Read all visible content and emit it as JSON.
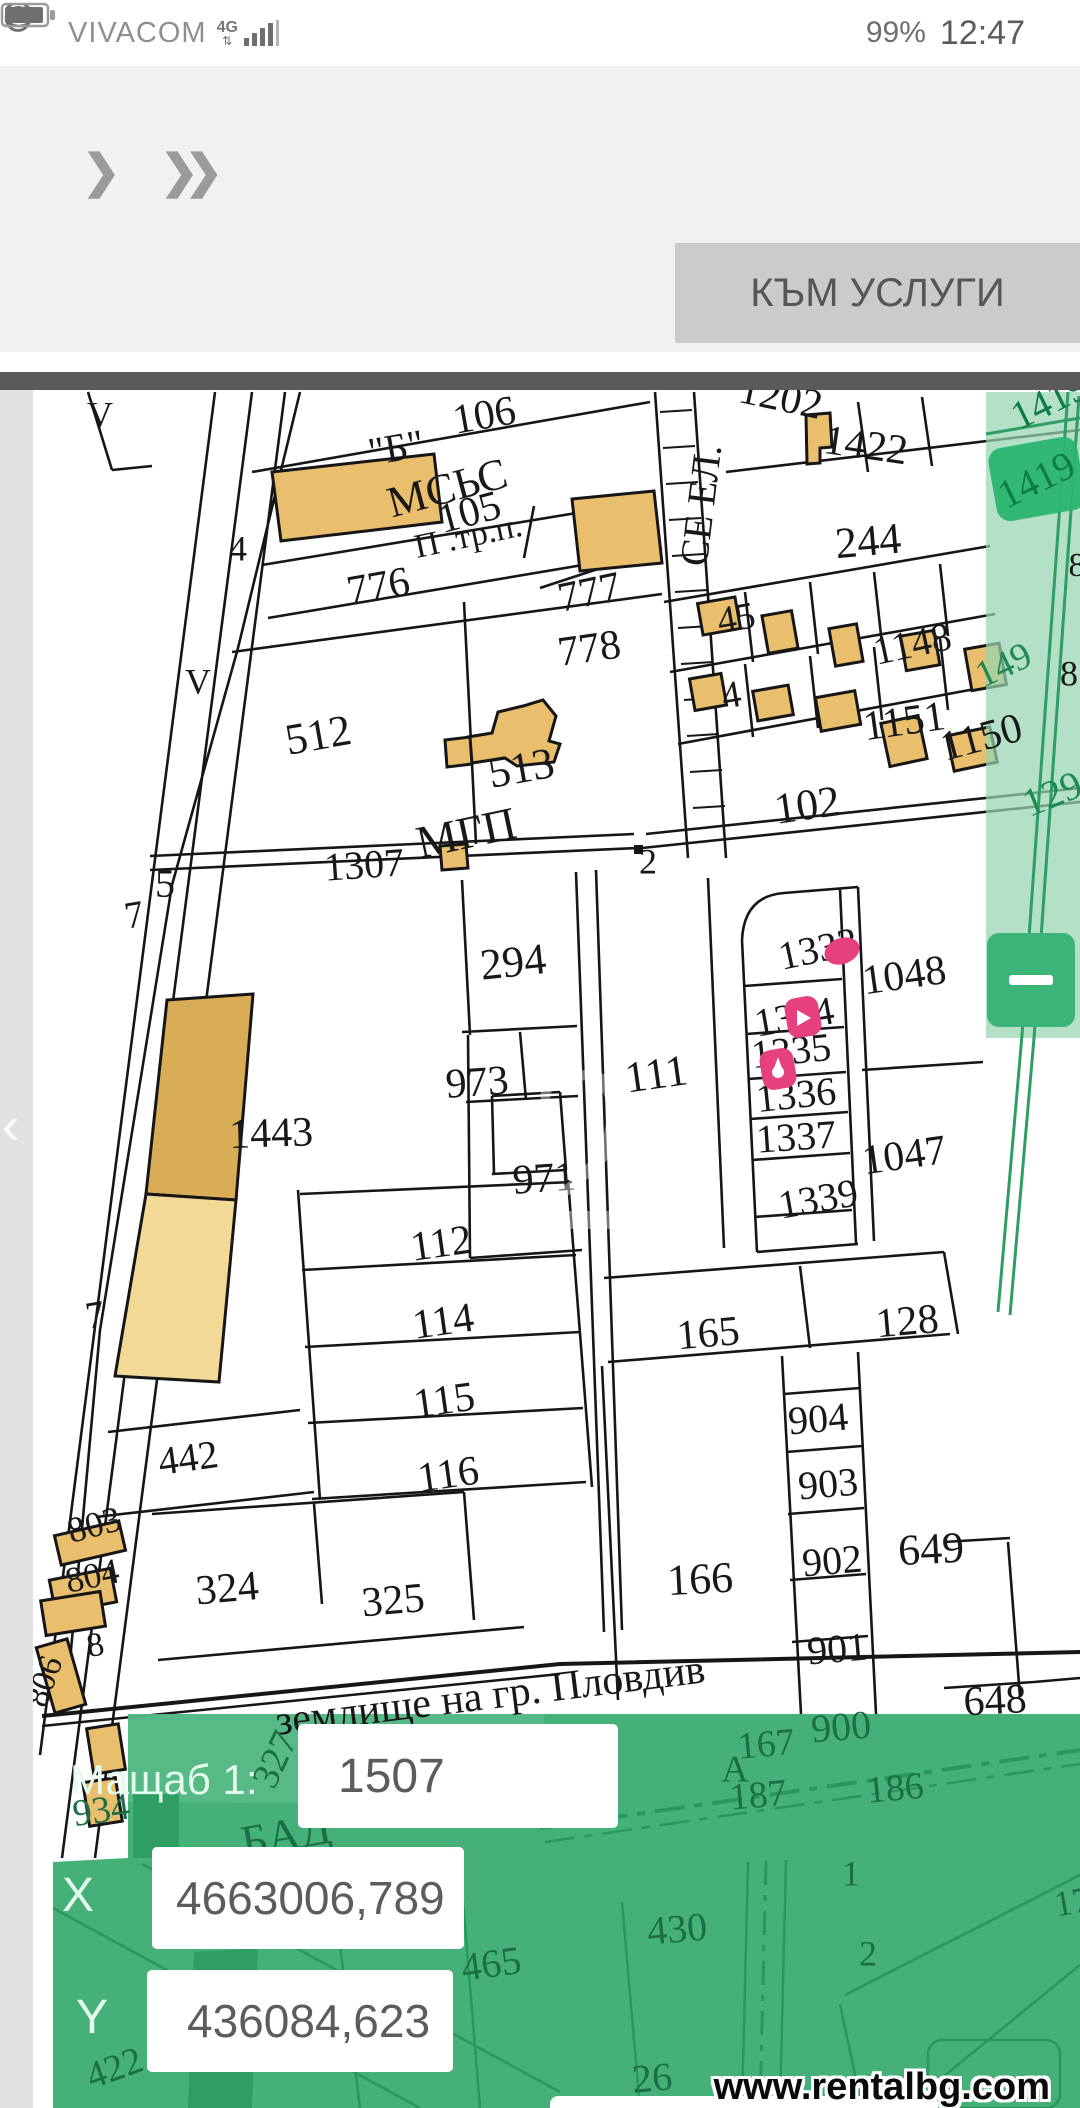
{
  "status_bar": {
    "carrier": "VIVACOM",
    "network": "4G",
    "battery_percent": "99%",
    "time": "12:47",
    "icons": [
      "data-arrows-icon",
      "signal-bars-icon",
      "eye-icon",
      "alarm-clock-icon",
      "battery-icon"
    ]
  },
  "toolbar": {
    "forward_label": "❯",
    "forward_double_label": "❯❯",
    "services_button": "КЪМ УСЛУГИ"
  },
  "map": {
    "back_chevron": "‹",
    "zoom_out_glyph": "–",
    "marker_color": "#e6407e",
    "label_colors": {
      "black": "#181818",
      "green": "#1e8a50",
      "green_dark": "#0e7c46",
      "panel": "#1c6f45",
      "faint": "rgba(255,255,255,0.40)"
    },
    "markers": [
      {
        "x": 842,
        "y": 951,
        "type": "blob"
      },
      {
        "x": 803,
        "y": 1017,
        "type": "pin"
      },
      {
        "x": 778,
        "y": 1069,
        "type": "pin2"
      }
    ],
    "labels": [
      {
        "t": "\"Б\"",
        "x": 396,
        "y": 447,
        "r": -10,
        "s": 40
      },
      {
        "t": "106",
        "x": 484,
        "y": 414,
        "r": -10,
        "s": 42
      },
      {
        "t": "МСЬС",
        "x": 447,
        "y": 487,
        "r": -15,
        "s": 44
      },
      {
        "t": "105",
        "x": 469,
        "y": 511,
        "r": -15,
        "s": 42
      },
      {
        "t": "П .тр.п.",
        "x": 468,
        "y": 535,
        "r": -12,
        "s": 34
      },
      {
        "t": "776",
        "x": 378,
        "y": 585,
        "r": -10,
        "s": 42
      },
      {
        "t": "777",
        "x": 589,
        "y": 591,
        "r": -12,
        "s": 42
      },
      {
        "t": "778",
        "x": 589,
        "y": 647,
        "r": -8,
        "s": 42
      },
      {
        "t": "1202",
        "x": 781,
        "y": 396,
        "r": 12,
        "s": 42
      },
      {
        "t": "1422",
        "x": 866,
        "y": 444,
        "r": 8,
        "s": 42
      },
      {
        "t": "244",
        "x": 868,
        "y": 540,
        "r": -5,
        "s": 44
      },
      {
        "t": "СЕ ЕЛ.",
        "x": 700,
        "y": 505,
        "r": -83,
        "s": 40
      },
      {
        "t": "45",
        "x": 736,
        "y": 617,
        "r": -10,
        "s": 38
      },
      {
        "t": "1148",
        "x": 912,
        "y": 643,
        "r": -12,
        "s": 40
      },
      {
        "t": "149",
        "x": 1003,
        "y": 664,
        "r": -25,
        "s": 38,
        "c": "green"
      },
      {
        "t": "4",
        "x": 731,
        "y": 694,
        "r": -10,
        "s": 38
      },
      {
        "t": "1151",
        "x": 904,
        "y": 720,
        "r": -8,
        "s": 42
      },
      {
        "t": "1150",
        "x": 981,
        "y": 736,
        "r": -15,
        "s": 42
      },
      {
        "t": "102",
        "x": 807,
        "y": 804,
        "r": -8,
        "s": 44
      },
      {
        "t": "129",
        "x": 1052,
        "y": 793,
        "r": -22,
        "s": 40,
        "c": "green"
      },
      {
        "t": "8",
        "x": 1069,
        "y": 673,
        "r": 0,
        "s": 36
      },
      {
        "t": "8",
        "x": 1077,
        "y": 564,
        "r": 0,
        "s": 34
      },
      {
        "t": "1419",
        "x": 1036,
        "y": 479,
        "r": -26,
        "s": 40,
        "c": "green_dark"
      },
      {
        "t": "1419",
        "x": 1049,
        "y": 400,
        "r": -26,
        "s": 40,
        "c": "green_dark"
      },
      {
        "t": "V",
        "x": 100,
        "y": 414,
        "r": 0,
        "s": 36
      },
      {
        "t": "4",
        "x": 238,
        "y": 548,
        "r": 0,
        "s": 36
      },
      {
        "t": "V",
        "x": 198,
        "y": 681,
        "r": 0,
        "s": 36
      },
      {
        "t": "5",
        "x": 165,
        "y": 883,
        "r": 0,
        "s": 40
      },
      {
        "t": "7",
        "x": 134,
        "y": 914,
        "r": -10,
        "s": 38
      },
      {
        "t": "7",
        "x": 95,
        "y": 1314,
        "r": -10,
        "s": 38
      },
      {
        "t": "512",
        "x": 318,
        "y": 734,
        "r": -10,
        "s": 44
      },
      {
        "t": "513",
        "x": 521,
        "y": 767,
        "r": -10,
        "s": 44
      },
      {
        "t": "МГП",
        "x": 466,
        "y": 832,
        "r": -12,
        "s": 46
      },
      {
        "t": "1307",
        "x": 364,
        "y": 864,
        "r": -4,
        "s": 40
      },
      {
        "t": "2",
        "x": 648,
        "y": 861,
        "r": 0,
        "s": 36
      },
      {
        "t": "294",
        "x": 513,
        "y": 961,
        "r": -6,
        "s": 44
      },
      {
        "t": "973",
        "x": 477,
        "y": 1081,
        "r": -4,
        "s": 42
      },
      {
        "t": "971",
        "x": 544,
        "y": 1177,
        "r": -4,
        "s": 42
      },
      {
        "t": "111",
        "x": 656,
        "y": 1073,
        "r": -8,
        "s": 44
      },
      {
        "t": "1443",
        "x": 271,
        "y": 1132,
        "r": -2,
        "s": 42
      },
      {
        "t": "1333",
        "x": 818,
        "y": 948,
        "r": -12,
        "s": 40
      },
      {
        "t": "1334",
        "x": 794,
        "y": 1016,
        "r": -10,
        "s": 40
      },
      {
        "t": "1335",
        "x": 791,
        "y": 1050,
        "r": -6,
        "s": 40
      },
      {
        "t": "1336",
        "x": 796,
        "y": 1094,
        "r": -6,
        "s": 40
      },
      {
        "t": "1337",
        "x": 796,
        "y": 1136,
        "r": -4,
        "s": 40
      },
      {
        "t": "1339",
        "x": 818,
        "y": 1198,
        "r": -10,
        "s": 40
      },
      {
        "t": "1048",
        "x": 904,
        "y": 974,
        "r": -8,
        "s": 42
      },
      {
        "t": "1047",
        "x": 904,
        "y": 1154,
        "r": -8,
        "s": 42
      },
      {
        "t": "112",
        "x": 441,
        "y": 1242,
        "r": -8,
        "s": 42
      },
      {
        "t": "114",
        "x": 443,
        "y": 1320,
        "r": -8,
        "s": 42
      },
      {
        "t": "115",
        "x": 444,
        "y": 1399,
        "r": -8,
        "s": 42
      },
      {
        "t": "116",
        "x": 448,
        "y": 1473,
        "r": -8,
        "s": 42
      },
      {
        "t": "442",
        "x": 188,
        "y": 1457,
        "r": -8,
        "s": 40
      },
      {
        "t": "165",
        "x": 708,
        "y": 1332,
        "r": -5,
        "s": 42
      },
      {
        "t": "128",
        "x": 907,
        "y": 1320,
        "r": -5,
        "s": 42
      },
      {
        "t": "904",
        "x": 818,
        "y": 1418,
        "r": -5,
        "s": 40
      },
      {
        "t": "903",
        "x": 828,
        "y": 1483,
        "r": -5,
        "s": 40
      },
      {
        "t": "902",
        "x": 832,
        "y": 1560,
        "r": -5,
        "s": 40
      },
      {
        "t": "901",
        "x": 837,
        "y": 1648,
        "r": -5,
        "s": 40
      },
      {
        "t": "900",
        "x": 841,
        "y": 1726,
        "r": -5,
        "s": 40,
        "c": "panel"
      },
      {
        "t": "649",
        "x": 931,
        "y": 1548,
        "r": -3,
        "s": 44
      },
      {
        "t": "648",
        "x": 995,
        "y": 1699,
        "r": -3,
        "s": 42
      },
      {
        "t": "166",
        "x": 700,
        "y": 1578,
        "r": -3,
        "s": 44
      },
      {
        "t": "324",
        "x": 227,
        "y": 1587,
        "r": -5,
        "s": 42
      },
      {
        "t": "325",
        "x": 393,
        "y": 1599,
        "r": -5,
        "s": 42
      },
      {
        "t": "803",
        "x": 94,
        "y": 1524,
        "r": -15,
        "s": 36
      },
      {
        "t": "804",
        "x": 92,
        "y": 1575,
        "r": -12,
        "s": 36
      },
      {
        "t": "8",
        "x": 95,
        "y": 1644,
        "r": -10,
        "s": 34
      },
      {
        "t": "806",
        "x": 43,
        "y": 1681,
        "r": -70,
        "s": 34
      },
      {
        "t": "землище на гр. Пловдив",
        "x": 490,
        "y": 1694,
        "r": -7,
        "s": 42
      },
      {
        "t": "167",
        "x": 766,
        "y": 1743,
        "r": -5,
        "s": 38,
        "c": "panel"
      },
      {
        "t": "А",
        "x": 735,
        "y": 1768,
        "r": 0,
        "s": 38,
        "c": "panel"
      },
      {
        "t": "187",
        "x": 758,
        "y": 1794,
        "r": -5,
        "s": 38,
        "c": "panel"
      },
      {
        "t": "186",
        "x": 895,
        "y": 1787,
        "r": -5,
        "s": 38,
        "c": "panel"
      },
      {
        "t": "327",
        "x": 274,
        "y": 1759,
        "r": -65,
        "s": 38,
        "c": "panel"
      },
      {
        "t": "934",
        "x": 101,
        "y": 1809,
        "r": -8,
        "s": 38,
        "c": "panel"
      },
      {
        "t": "БАД",
        "x": 286,
        "y": 1834,
        "r": -10,
        "s": 46,
        "c": "panel"
      },
      {
        "t": "465",
        "x": 491,
        "y": 1963,
        "r": -8,
        "s": 40,
        "c": "panel"
      },
      {
        "t": "422",
        "x": 114,
        "y": 2067,
        "r": -20,
        "s": 38,
        "c": "panel"
      },
      {
        "t": "430",
        "x": 677,
        "y": 1928,
        "r": -5,
        "s": 40,
        "c": "panel"
      },
      {
        "t": "26",
        "x": 652,
        "y": 2077,
        "r": -5,
        "s": 40,
        "c": "panel"
      },
      {
        "t": "1",
        "x": 851,
        "y": 1873,
        "r": 0,
        "s": 36,
        "c": "panel"
      },
      {
        "t": "2",
        "x": 868,
        "y": 1953,
        "r": 0,
        "s": 36,
        "c": "panel"
      },
      {
        "t": "17",
        "x": 1072,
        "y": 1901,
        "r": -10,
        "s": 36,
        "c": "panel"
      },
      {
        "t": "2",
        "x": 585,
        "y": 1145,
        "r": 0,
        "s": 240,
        "c": "faint"
      }
    ]
  },
  "panel": {
    "scale_label": "Мащаб  1:",
    "scale_value": "1507",
    "x_label": "X",
    "x_value": "4663006,789",
    "y_label": "Y",
    "y_value": "436084,623"
  },
  "watermark": "www.rentalbg.com"
}
